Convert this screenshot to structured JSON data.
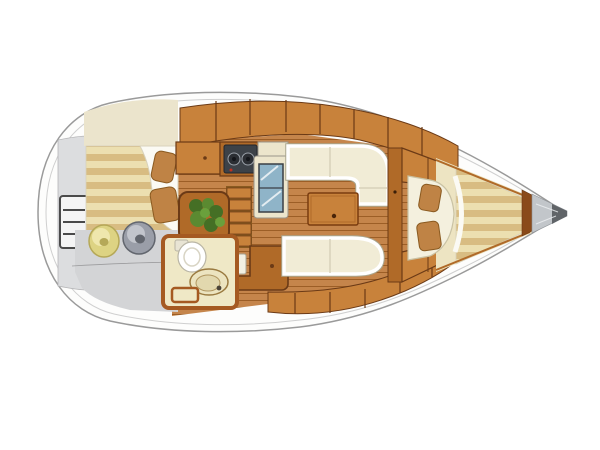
{
  "diagram": {
    "type": "yacht-interior-layout-plan",
    "orientation": "bow-right",
    "areas": [
      "hull",
      "transom-platform",
      "swim-ladder",
      "aft-cabin-berth",
      "aft-cabin-floor",
      "pouf-yellow",
      "pouf-gray",
      "head-compartment",
      "toilet",
      "sink",
      "companionway-steps",
      "nav-seat",
      "chart-table",
      "plant-table",
      "galley-cabinet",
      "stove",
      "counter",
      "fridge",
      "salon-floor",
      "salon-table",
      "settee-starboard",
      "settee-port",
      "top-lockers",
      "bottom-lockers",
      "bulkhead",
      "forward-cabin",
      "v-berth-headboard",
      "v-berth-mattress",
      "anchor-locker"
    ]
  },
  "palette": {
    "hull_fill": "#fdfdfc",
    "hull_line": "#9a9a9a",
    "inner_line": "#cfcfcf",
    "transom_gray": "#dcdddf",
    "transom_line": "#b5b5b7",
    "ladder_fill": "#f4f4f4",
    "ladder_line": "#4a4a4a",
    "teak": "#c5854b",
    "teak_line": "#9c5e26",
    "wood": "#c8823b",
    "wood_dark": "#6b3a16",
    "wood_mid": "#b06a28",
    "stripe_light": "#ecdfb0",
    "stripe_dark": "#d8bc82",
    "bedding_white": "#fbfaf4",
    "bedding_line": "#d8d2bc",
    "pillow_brown": "#bf8345",
    "pillow_line": "#8a5a20",
    "floor_gray": "#d3d4d6",
    "floor_gray_line": "#9c9c9e",
    "pouf_yellow": "#ddd383",
    "pouf_yellow_hi": "#efe7ad",
    "pouf_yellow_line": "#b5a858",
    "pouf_gray": "#9a9ea8",
    "pouf_gray_hi": "#c2c5cc",
    "pouf_gray_dark": "#62666e",
    "cream_wall": "#ebe4cc",
    "head_floor": "#efe8c6",
    "head_wall": "#a55a22",
    "porcelain": "#ffffff",
    "porcelain_line": "#b9b5a5",
    "sink_fill": "#ece4c0",
    "sink_line": "#9a7a40",
    "counter_cream": "#ece5cc",
    "counter_line": "#9a958a",
    "fridge_blue": "#8fb4c8",
    "fridge_line": "#3a3f45",
    "stove_dark": "#3d4248",
    "burner_dark": "#2b2e33",
    "burner_ring": "#9aa0a8",
    "knob_red": "#c03020",
    "settee_cream": "#f1ecd6",
    "settee_pipe": "#ffffff",
    "settee_halo": "#aaa68e",
    "settee_seam": "#d8d2ba",
    "plant_dark": "#456f25",
    "plant_mid": "#5b8a31",
    "plant_light": "#6aa03c",
    "v_cream": "#ede4c2",
    "headboard_cream": "#f4f0de",
    "headboard_line": "#c9c2a4",
    "bow_gray": "#c2c6ca",
    "bow_gray_line": "#8d9196",
    "bow_dark": "#606468",
    "trim_brown": "#8a4a1a"
  }
}
